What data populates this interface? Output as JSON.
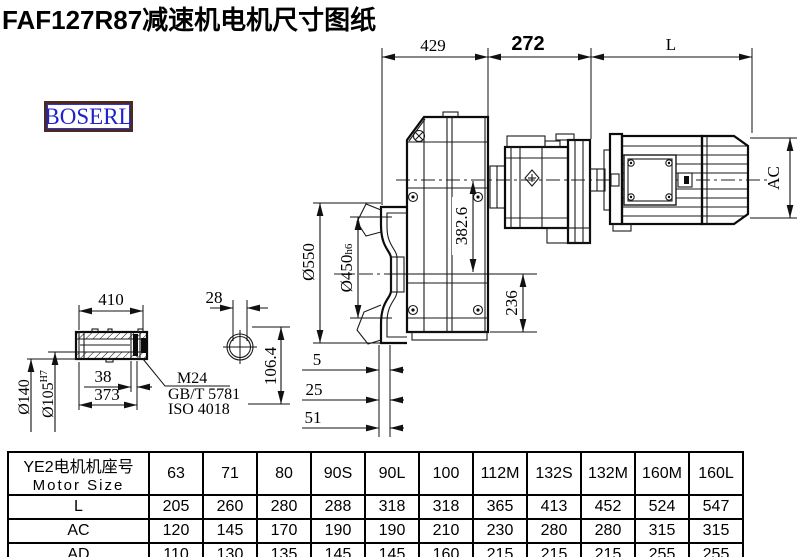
{
  "title": "FAF127R87减速机电机尺寸图纸",
  "logo": {
    "text": "BOSERL",
    "border_color": "#4b2b20",
    "text_color": "#2222cc"
  },
  "drawing": {
    "top_dims": {
      "d429": "429",
      "d272": "272",
      "dL": "L"
    },
    "main_dims": {
      "ac": "AC",
      "d382": "382.6",
      "d236": "236",
      "d550": "Ø550",
      "d450": "Ø450",
      "d450_suffix": "h6",
      "d5": "5",
      "d25": "25",
      "d51": "51"
    },
    "shaft_dims": {
      "d410": "410",
      "d38": "38",
      "d373": "373",
      "d140": "Ø140",
      "d105": "Ø105",
      "d105_sup": "H7",
      "d28": "28",
      "d106": "106.4",
      "thread": "M24",
      "std1": "GB/T 5781",
      "std2": "ISO 4018"
    }
  },
  "table": {
    "header_cn": "YE2电机机座号",
    "header_en": "Motor Size",
    "columns": [
      "63",
      "71",
      "80",
      "90S",
      "90L",
      "100",
      "112M",
      "132S",
      "132M",
      "160M",
      "160L"
    ],
    "rows": [
      {
        "label": "L",
        "values": [
          "205",
          "260",
          "280",
          "288",
          "318",
          "318",
          "365",
          "413",
          "452",
          "524",
          "547"
        ]
      },
      {
        "label": "AC",
        "values": [
          "120",
          "145",
          "170",
          "190",
          "190",
          "210",
          "230",
          "280",
          "280",
          "315",
          "315"
        ]
      },
      {
        "label": "AD",
        "values": [
          "110",
          "130",
          "135",
          "145",
          "145",
          "160",
          "215",
          "215",
          "215",
          "255",
          "255"
        ]
      }
    ]
  }
}
